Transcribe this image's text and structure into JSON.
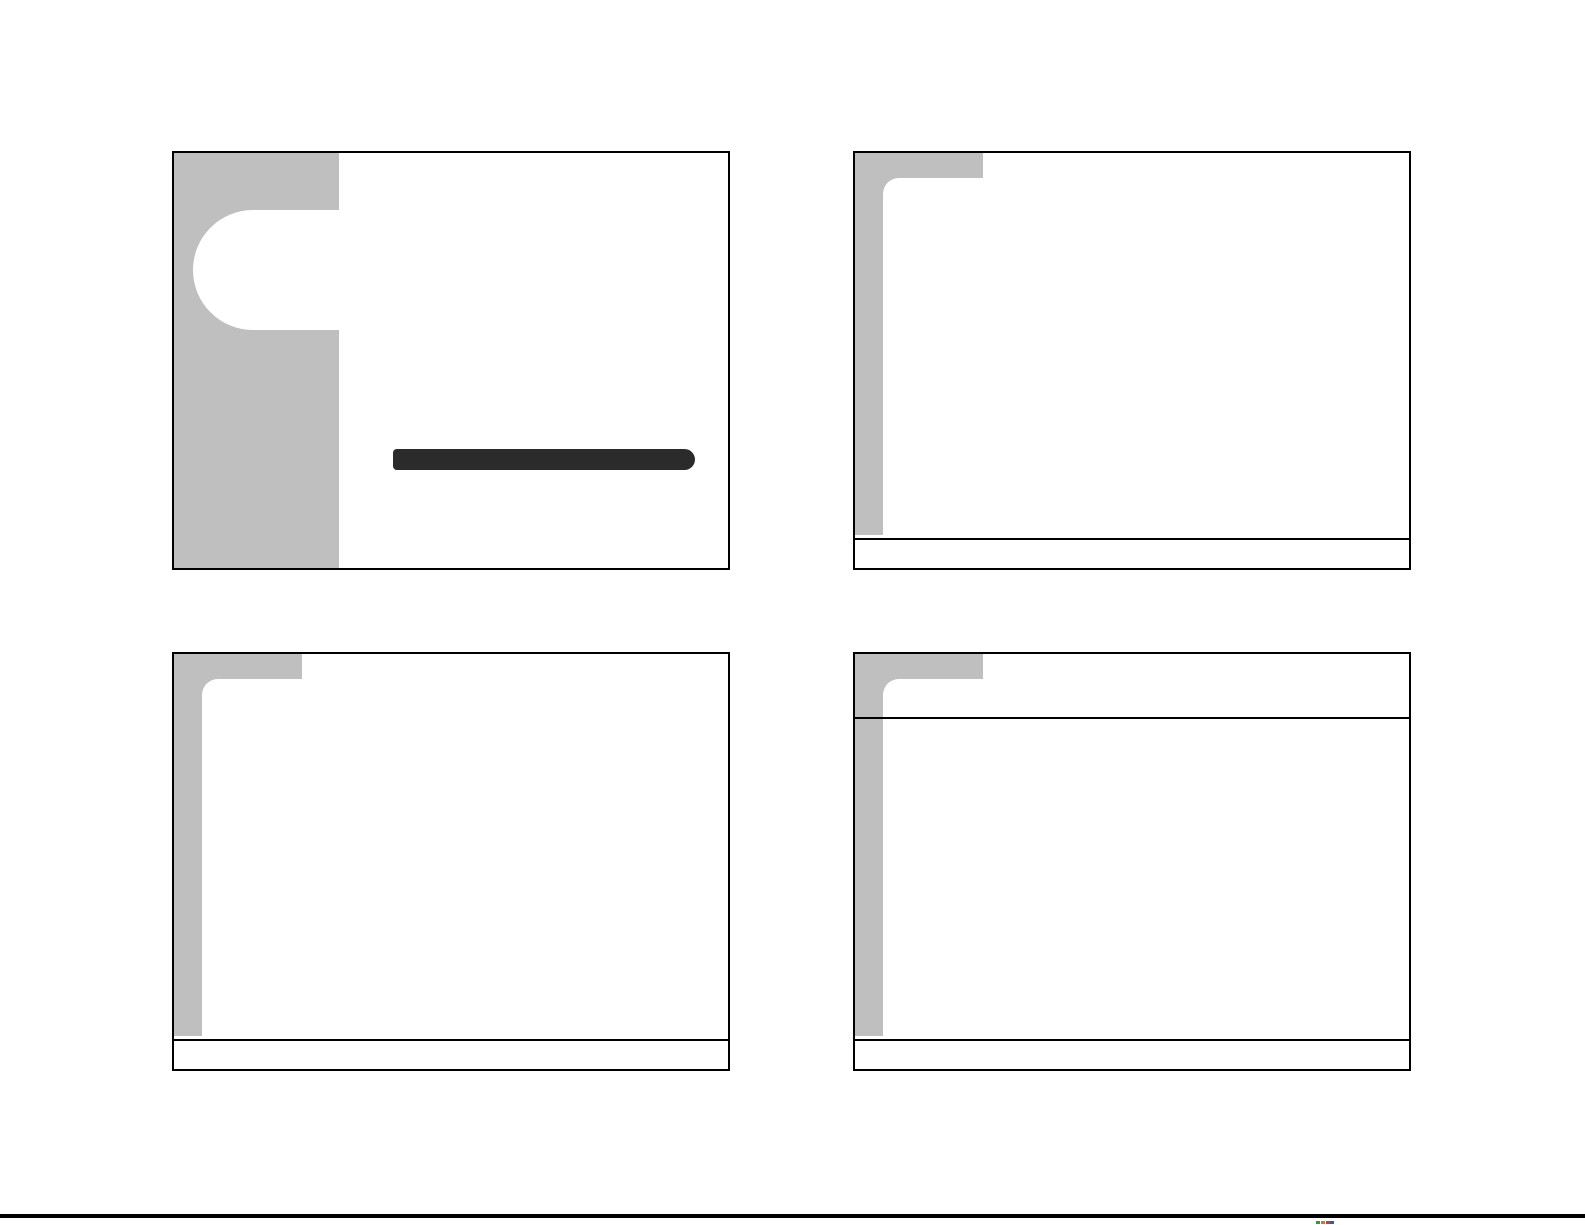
{
  "page": {
    "background": "#ffffff",
    "bottom_bar": {
      "color": "#000000"
    },
    "bottom_marks": [
      {
        "label": "mark-1",
        "color": "#2e9e2e"
      },
      {
        "label": "mark-2",
        "color": "#d8742c"
      },
      {
        "label": "mark-3",
        "color": "#d23a3a"
      },
      {
        "label": "mark-4",
        "color": "#3a50c8"
      }
    ]
  },
  "theme": {
    "slide_background": "#ffffff",
    "slide_border": "#000000",
    "accent_gray": "#bfbfbf",
    "title_rule": "#2b2b2b",
    "divider_line": "#000000"
  },
  "slides": [
    {
      "position": "top-left",
      "variant": "title-slide"
    },
    {
      "position": "top-right",
      "variant": "content-slide"
    },
    {
      "position": "bottom-left",
      "variant": "content-slide"
    },
    {
      "position": "bottom-right",
      "variant": "title-and-content-slide"
    }
  ]
}
